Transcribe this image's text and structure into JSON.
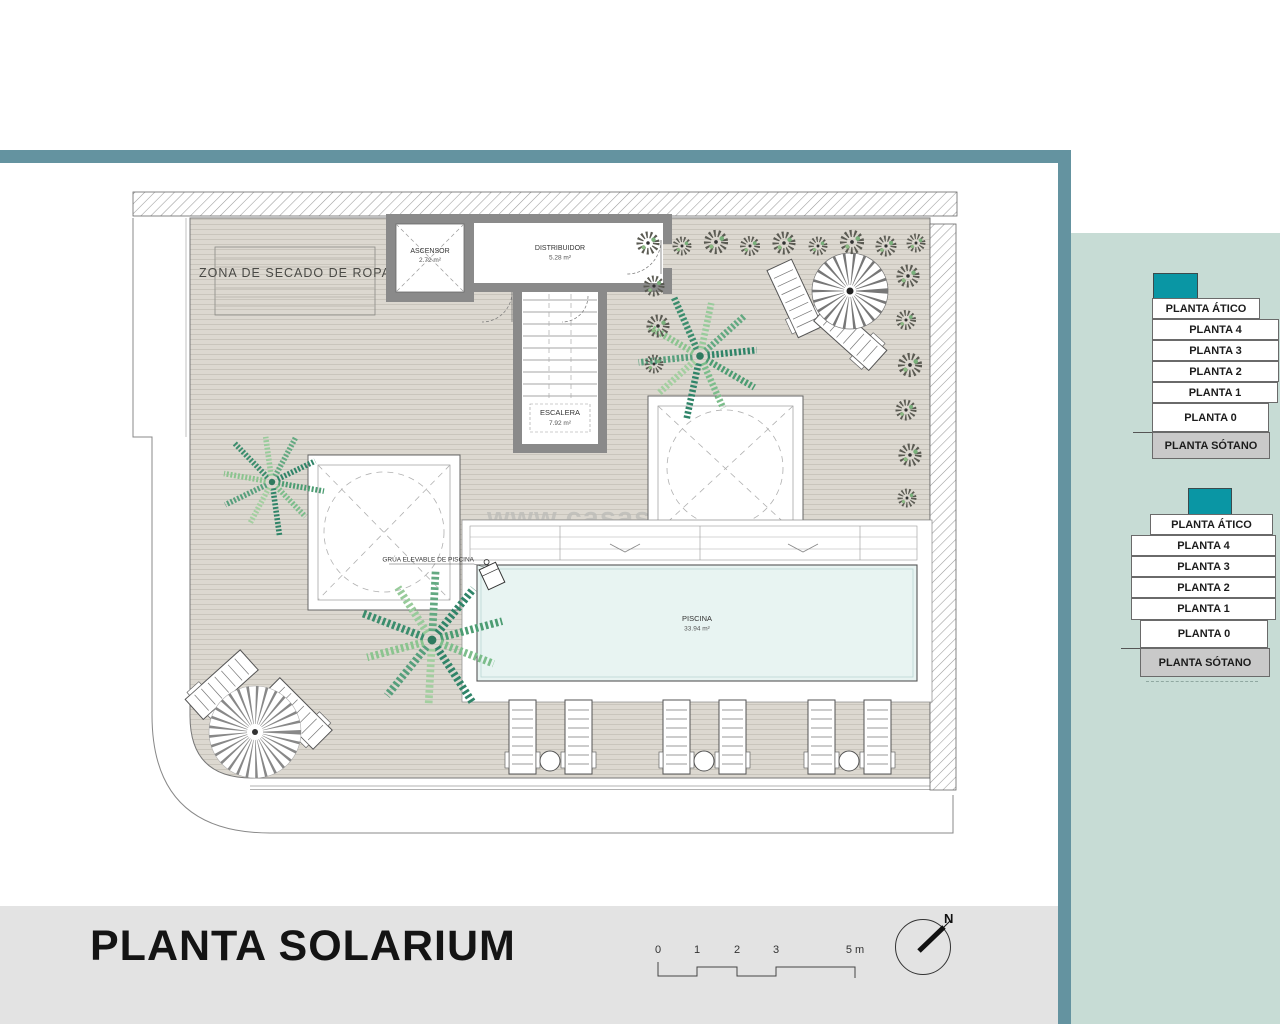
{
  "plan": {
    "zona_secado_label": "ZONA DE SECADO DE ROPA",
    "ascensor": {
      "name": "ASCENSOR",
      "area": "2.72 m²"
    },
    "distribuidor": {
      "name": "DISTRIBUIDOR",
      "area": "5.28 m²"
    },
    "escalera": {
      "name": "ESCALERA",
      "area": "7.92 m²"
    },
    "piscina": {
      "name": "PISCINA",
      "area": "33.94 m²"
    },
    "grua_label": "GRÚA ELEVABLE DE PISCINA",
    "watermark": "www.casasw"
  },
  "sidebar": {
    "stack_top": {
      "floors": [
        "PLANTA ÁTICO",
        "PLANTA 4",
        "PLANTA 3",
        "PLANTA 2",
        "PLANTA 1",
        "PLANTA 0",
        "PLANTA SÓTANO"
      ]
    },
    "stack_bottom": {
      "floors": [
        "PLANTA ÁTICO",
        "PLANTA 4",
        "PLANTA 3",
        "PLANTA 2",
        "PLANTA 1",
        "PLANTA 0",
        "PLANTA SÓTANO"
      ]
    }
  },
  "footer": {
    "title": "PLANTA SOLARIUM",
    "scale_ticks": [
      "0",
      "1",
      "2",
      "3",
      "5 m"
    ],
    "compass_north": "N"
  },
  "colors": {
    "accent_teal": "#0a96a4",
    "frame_teal": "#6493a0",
    "sidebar_bg": "#c7dcd5",
    "footer_bg": "#e3e3e3",
    "deck": "#dcd8d0",
    "pool": "#e8f4f2",
    "wall_gray": "#8a8a8a",
    "sotano_gray": "#c9c9c9"
  }
}
